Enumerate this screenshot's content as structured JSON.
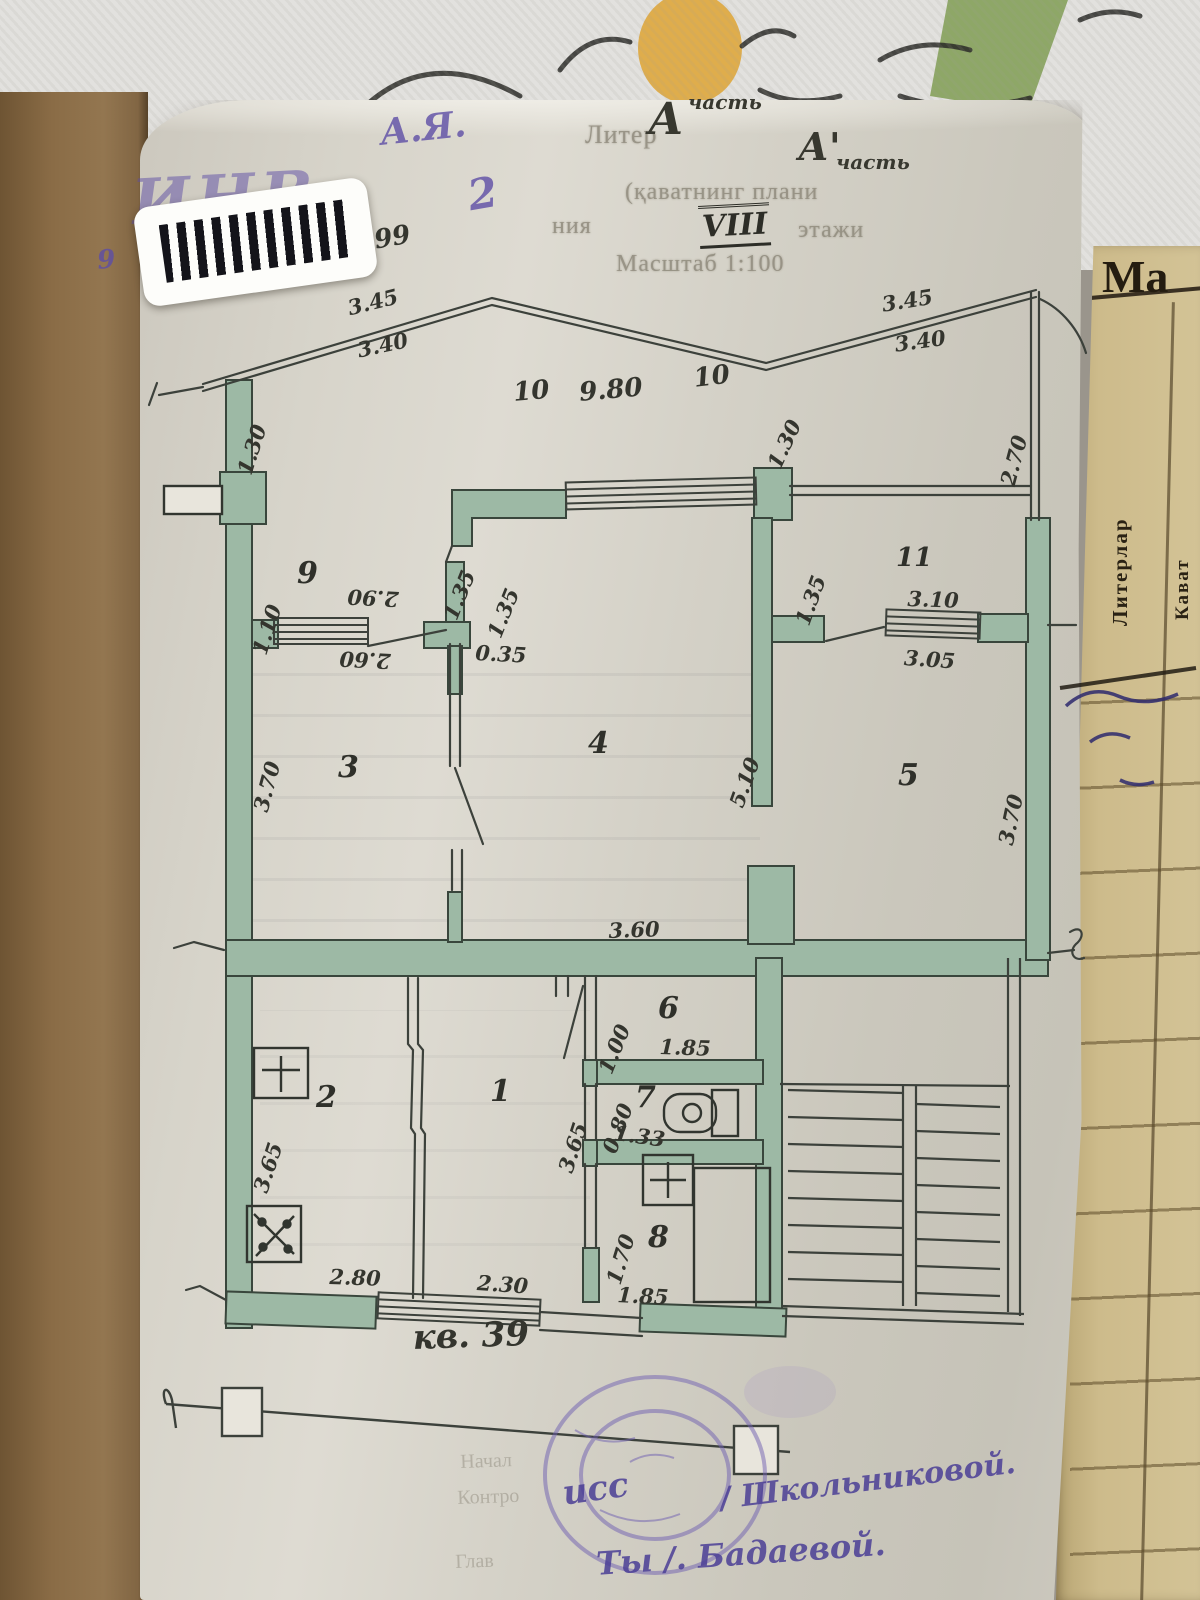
{
  "photo": {
    "inv_stamp": "ИНВ",
    "handwriting": {
      "initials": "А.Я.",
      "digit2": "2",
      "digits99": "99",
      "digit9": "9"
    },
    "colors": {
      "wall_fill": "#9db9a5",
      "ink": "#3c413b",
      "stamp_purple": "#6f5fb2",
      "tracing_paper": "#d2cfc6",
      "cover_brown": "#8a6c46",
      "side_page_tan": "#cdbb8b"
    }
  },
  "form": {
    "liter_label": "Литер",
    "liter_value": "А",
    "liter_value_sup": "часть",
    "liter_value2": "А'",
    "liter_value2_sub": "часть",
    "line2": "(қаватнинг плани",
    "line3_left": "ния",
    "floor_number": "VIII",
    "line3_right": "этажи",
    "scale_line": "Масштаб 1:100"
  },
  "plan": {
    "apartment_label": "кв. 39",
    "rooms": {
      "r1": "1",
      "r2": "2",
      "r3": "3",
      "r4": "4",
      "r5": "5",
      "r6": "6",
      "r7": "7",
      "r8": "8",
      "r9": "9",
      "r11": "11"
    },
    "dims": {
      "d01": "3.45",
      "d02": "3.40",
      "d03": "3.45",
      "d04": "3.40",
      "d05": "10",
      "d06": "9.80",
      "d07": "10",
      "d08": "1.30",
      "d09": "2.70",
      "d10": "1.30",
      "d11": "1.10",
      "d12": "2.90",
      "d13": "2.60",
      "d14": "1.35",
      "d15": "1.35",
      "d16": "0.35",
      "d17": "1.35",
      "d18": "3.10",
      "d19": "3.05",
      "d20": "3.70",
      "d21": "5.10",
      "d22": "3.70",
      "d23": "3.60",
      "d24": "1.00",
      "d25": "1.85",
      "d26": "0.80",
      "d27": "1.33",
      "d28": "3.65",
      "d29": "1.70",
      "d30": "1.85",
      "d31": "3.65",
      "d32": "2.80",
      "d33": "2.30"
    }
  },
  "side_page": {
    "title": "Ма",
    "col_literlar": "Литерлар",
    "col_kavat": "Кават"
  },
  "footer": {
    "print1": "Начал",
    "print2": "Контро",
    "print3": "Глав",
    "sig1_prefix": "исс",
    "sig1": "/ Школьниковой.",
    "sig2": "Ты  /. Бадаевой."
  }
}
